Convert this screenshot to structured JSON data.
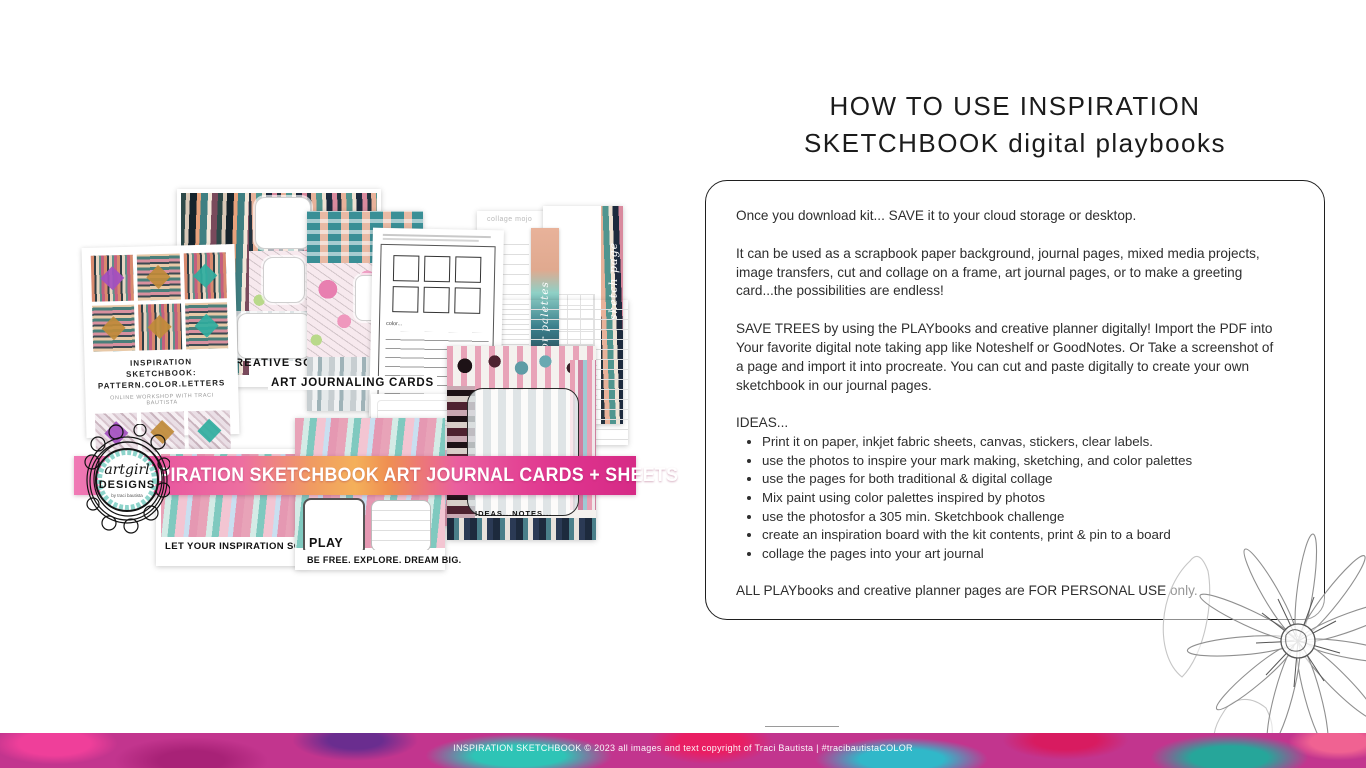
{
  "header": {
    "title_line1": "HOW TO USE INSPIRATION",
    "title_line2": "SKETCHBOOK digital playbooks"
  },
  "instructions": {
    "intro": "Once you download kit... SAVE it to your cloud storage or desktop.",
    "uses": "It can be used as a scrapbook paper background, journal pages, mixed media projects, image transfers, cut and collage on a frame, art journal pages, or to make a greeting card...the possibilities are endless!",
    "save_trees": "SAVE TREES  by using the PLAYbooks and creative planner digitally! Import the PDF into Your favorite  digital note taking app like Noteshelf or GoodNotes. Or Take a screenshot of a page and import it into procreate. You can cut and paste digitally to create your own sketchbook in our journal pages.",
    "ideas_label": "IDEAS...",
    "bullets": [
      "Print it on paper, inkjet fabric sheets, canvas, stickers, clear labels.",
      "use the photos to inspire your mark making, sketching, and color palettes",
      "use the pages for both traditional & digital collage",
      "Mix paint using color palettes inspired by photos",
      "use the photosfor a 305 min. Sketchbook challenge",
      "create an inspiration board with the kit contents, print & pin to a board",
      "collage the pages into your art journal"
    ],
    "personal_use": "ALL PLAYbooks and creative planner pages are FOR PERSONAL USE only."
  },
  "collage": {
    "title_card": {
      "line1": "INSPIRATION SKETCHBOOK:",
      "line2": "PATTERN.COLOR.LETTERS",
      "subtitle": "ONLINE WORKSHOP WITH TRACI BAUTISTA"
    },
    "labels": {
      "creative_soul": "A CREATIVE SOUL.",
      "art_journaling_cards": "ART JOURNALING CARDS",
      "inspire": "INSPIRE",
      "play": "PLAY",
      "be_free": "BE FREE. EXPLORE. DREAM BIG.",
      "soar": "LET YOUR INSPIRATION SOAR.",
      "ideas_notes": "IDEAS...NOTES...",
      "color_palettes": "color palettes",
      "sketch_page": "sketch page",
      "collage_mojo": "collage mojo",
      "color_field": "color..."
    },
    "banner_text": "INSPIRATION SKETCHBOOK ART JOURNAL CARDS + SHEETS",
    "logo": {
      "script": "artgirl",
      "name": "DESIGNS",
      "byline": "by traci bautista"
    }
  },
  "footer": {
    "copyright": "INSPIRATION SKETCHBOOK © 2023 all images and text copyright of Traci Bautista | #tracibautistaCOLOR"
  },
  "colors": {
    "banner_pink": "#e8559f",
    "logo_teal": "#8ed4cb",
    "footer_magenta": "#c2358e",
    "text_dark": "#2e2e2e"
  }
}
